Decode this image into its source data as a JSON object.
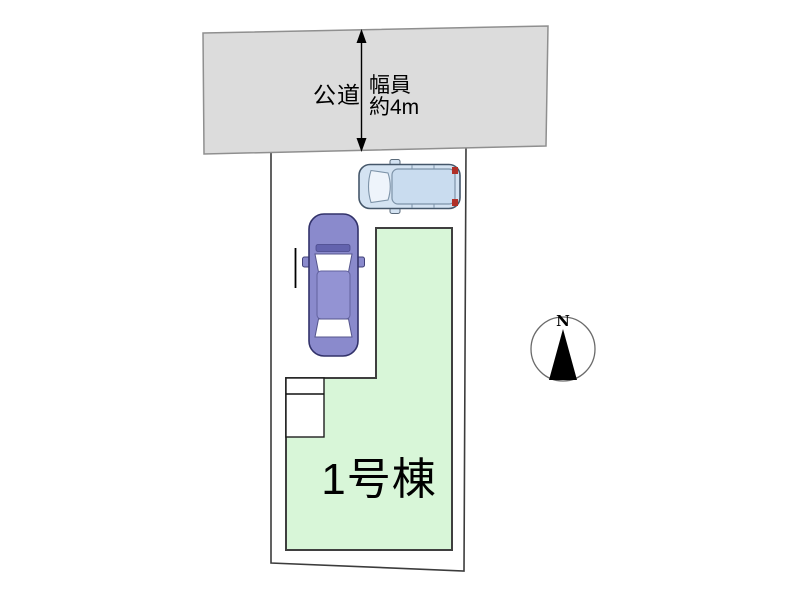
{
  "canvas": {
    "width_px": 800,
    "height_px": 600
  },
  "road": {
    "label": "公道",
    "width_note_line1": "幅員",
    "width_note_line2": "約4m"
  },
  "plot": {
    "building_label": "1号棟"
  },
  "compass": {
    "north_label": "N"
  },
  "icons": {
    "car_top": "car-top-view-icon",
    "compass": "north-compass-icon",
    "width_arrow": "double-headed-arrow-icon"
  },
  "colors": {
    "road_fill": "#dcdcdc",
    "road_stroke": "#8f8f8f",
    "plot_fill": "#ffffff",
    "plot_stroke": "#3c3c3c",
    "building_fill": "#d8f6d8",
    "building_stroke": "#3f3f3f",
    "car_light_body": "#d4e3f2",
    "car_light_outline": "#45576a",
    "car_purple_body": "#8a8acc",
    "car_purple_outline": "#32326a",
    "taillight_red": "#b03028",
    "arrow_black": "#000000"
  }
}
